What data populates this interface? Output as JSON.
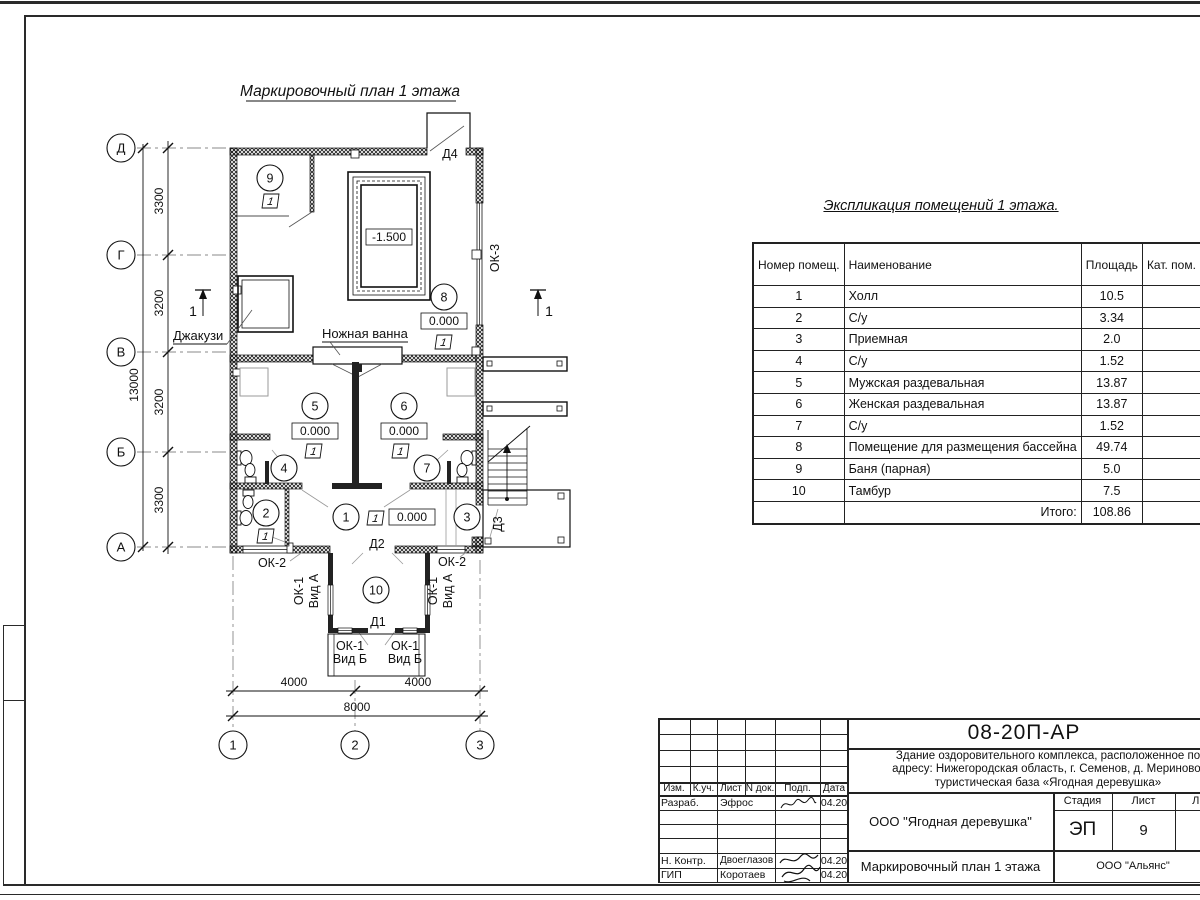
{
  "sheet": {
    "plan_title": "Маркировочный план 1 этажа"
  },
  "plan": {
    "axes_left": [
      "Д",
      "Г",
      "В",
      "Б",
      "А"
    ],
    "axes_bottom": [
      "1",
      "2",
      "3"
    ],
    "dims_left": [
      "3300",
      "3200",
      "3200",
      "3300"
    ],
    "dim_left_total": "13000",
    "dims_bottom": [
      "4000",
      "4000"
    ],
    "dim_bottom_total": "8000",
    "rooms": [
      "1",
      "2",
      "3",
      "4",
      "5",
      "6",
      "7",
      "8",
      "9",
      "10"
    ],
    "levels": {
      "zero": "0.000",
      "pool": "-1.500"
    },
    "floor_marker": "1",
    "section_mark": "1",
    "labels": {
      "jacuzzi": "Джакузи",
      "foot_bath": "Ножная ванна",
      "d1": "Д1",
      "d2": "Д2",
      "d3": "Д3",
      "d4": "Д4",
      "ok1": "ОК-1",
      "vid_a": "Вид А",
      "vid_b": "Вид Б",
      "ok2": "ОК-2",
      "ok3": "ОК-3"
    }
  },
  "explication": {
    "title": "Экспликация помещений 1 этажа.",
    "headers": [
      "Номер помещ.",
      "Наименование",
      "Площадь",
      "Кат. пом."
    ],
    "rows": [
      {
        "num": "1",
        "name": "Холл",
        "area": "10.5"
      },
      {
        "num": "2",
        "name": "С/у",
        "area": "3.34"
      },
      {
        "num": "3",
        "name": "Приемная",
        "area": "2.0"
      },
      {
        "num": "4",
        "name": "С/у",
        "area": "1.52"
      },
      {
        "num": "5",
        "name": "Мужская раздевальная",
        "area": "13.87"
      },
      {
        "num": "6",
        "name": "Женская раздевальная",
        "area": "13.87"
      },
      {
        "num": "7",
        "name": "С/у",
        "area": "1.52"
      },
      {
        "num": "8",
        "name": "Помещение для размещения бассейна",
        "area": "49.74"
      },
      {
        "num": "9",
        "name": "Баня (парная)",
        "area": "5.0"
      },
      {
        "num": "10",
        "name": "Тамбур",
        "area": "7.5"
      }
    ],
    "total_label": "Итого:",
    "total_value": "108.86"
  },
  "titleblock": {
    "doc_number": "08-20П-АР",
    "description_lines": [
      "Здание оздоровительного комплекса, расположенное по",
      "адресу: Нижегородская область, г. Семенов, д. Мериново,",
      "туристическая база «Ягодная деревушка»"
    ],
    "org": "ООО \"Ягодная деревушка\"",
    "drawing_name": "Маркировочный план 1 этажа",
    "contractor": "ООО \"Альянс\"",
    "stage_label": "Стадия",
    "sheet_label": "Лист",
    "sheets_label": "Листов",
    "stage": "ЭП",
    "sheet_number": "9",
    "header_cols": [
      "Изм.",
      "К.уч.",
      "Лист",
      "N док.",
      "Подп.",
      "Дата"
    ],
    "sign_rows": [
      {
        "role": "Разраб.",
        "name": "Эфрос",
        "date": "04.20"
      },
      {
        "role": "Н. Контр.",
        "name": "Двоеглазов",
        "date": "04.20"
      },
      {
        "role": "ГИП",
        "name": "Коротаев",
        "date": "04.20"
      }
    ]
  }
}
